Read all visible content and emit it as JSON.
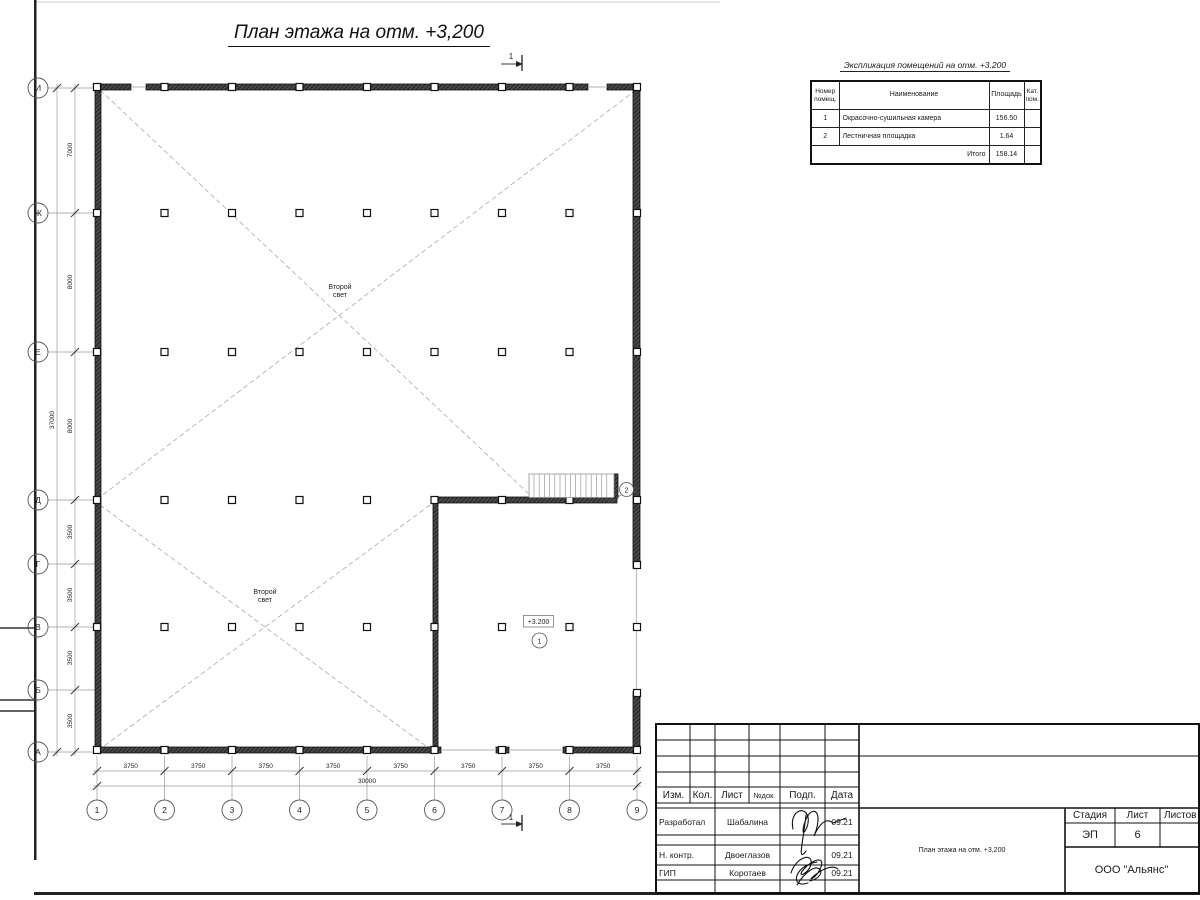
{
  "title": "План этажа на отм. +3,200",
  "plan": {
    "section_mark": "1",
    "row_axes": [
      "И",
      "Ж",
      "Е",
      "Д",
      "Г",
      "В",
      "Б",
      "А"
    ],
    "col_axes": [
      "1",
      "2",
      "3",
      "4",
      "5",
      "6",
      "7",
      "8",
      "9"
    ],
    "v_dims": [
      "7000",
      "8000",
      "8000",
      "3500",
      "3500",
      "3500",
      "3500"
    ],
    "v_total": "37000",
    "h_dims": [
      "3750",
      "3750",
      "3750",
      "3750",
      "3750",
      "3750",
      "3750",
      "3750"
    ],
    "h_total": "30000",
    "second_light_line1": "Второй",
    "second_light_line2": "свет",
    "elev_mark": "+3.200",
    "room1": "1",
    "room2": "2"
  },
  "explication": {
    "title": "Экспликация помещений на отм. +3.200",
    "headers": {
      "num1": "Номер",
      "num2": "помещ.",
      "name": "Наименование",
      "area": "Площадь",
      "cat1": "Кат.",
      "cat2": "пом."
    },
    "rows": [
      {
        "num": "1",
        "name": "Окрасочно-сушильная камера",
        "area": "156.50"
      },
      {
        "num": "2",
        "name": "Лестничная площадка",
        "area": "1.64"
      }
    ],
    "total_label": "Итого",
    "total_area": "158.14"
  },
  "titleblock": {
    "cols": [
      "Изм.",
      "Кол.",
      "Лист",
      "№док.",
      "Подп.",
      "Дата"
    ],
    "rows": [
      {
        "role": "Разработал",
        "name": "Шабалина",
        "date": "09.21"
      },
      {
        "role": "Н. контр.",
        "name": "Двоеглазов",
        "date": "09.21"
      },
      {
        "role": "ГИП",
        "name": "Коротаев",
        "date": "09.21"
      }
    ],
    "doc_title": "План этажа на отм. +3,200",
    "stage_label": "Стадия",
    "sheet_label": "Лист",
    "sheets_label": "Листов",
    "stage": "ЭП",
    "sheet": "6",
    "company": "ООО \"Альянс\""
  }
}
